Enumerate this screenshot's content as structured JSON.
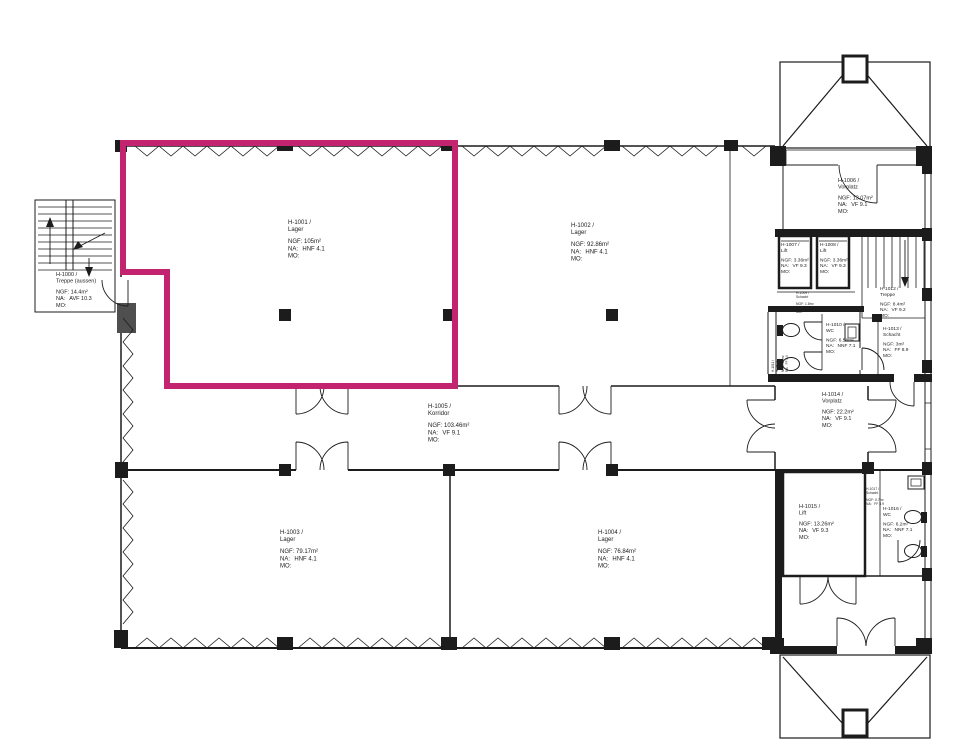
{
  "colors": {
    "highlight": "#c2246f",
    "line": "#1c1c1c"
  },
  "selection": {
    "room_id": "H-1001",
    "room_type": "Lager"
  },
  "rooms": {
    "h1000": {
      "id": "H-1000 /",
      "name": "Treppe (aussen)",
      "ngf": "NGF: 14.4m²",
      "na_label": "NA:",
      "na": "AVF 10.3",
      "mo": "MO:"
    },
    "h1001": {
      "id": "H-1001 /",
      "name": "Lager",
      "ngf": "NGF: 105m²",
      "na_label": "NA:",
      "na": "HNF 4.1",
      "mo": "MO:"
    },
    "h1002": {
      "id": "H-1002 /",
      "name": "Lager",
      "ngf": "NGF: 92.86m²",
      "na_label": "NA:",
      "na": "HNF 4.1",
      "mo": "MO:"
    },
    "h1003": {
      "id": "H-1003 /",
      "name": "Lager",
      "ngf": "NGF: 79.17m²",
      "na_label": "NA:",
      "na": "HNF 4.1",
      "mo": "MO:"
    },
    "h1004": {
      "id": "H-1004 /",
      "name": "Lager",
      "ngf": "NGF: 76.84m²",
      "na_label": "NA:",
      "na": "HNF 4.1",
      "mo": "MO:"
    },
    "h1005": {
      "id": "H-1005 /",
      "name": "Korridor",
      "ngf": "NGF: 103.46m²",
      "na_label": "NA:",
      "na": "VF 9.1",
      "mo": "MO:"
    },
    "h1006": {
      "id": "H-1006 /",
      "name": "Vorplatz",
      "ngf": "NGF: 13.07m²",
      "na_label": "NA:",
      "na": "VF 9.1",
      "mo": "MO:"
    },
    "h1007": {
      "id": "H-1007 /",
      "name": "Lift",
      "ngf": "NGF: 3.36m²",
      "na_label": "NA:",
      "na": "VF 9.3",
      "mo": "MO:"
    },
    "h1008": {
      "id": "H-1008 /",
      "name": "Lift",
      "ngf": "NGF: 3.36m²",
      "na_label": "NA:",
      "na": "VF 9.3",
      "mo": "MO:"
    },
    "h1009": {
      "id": "H-1009 /",
      "name": "Schacht",
      "ngf": "NGF: 1.8m²",
      "na_label": "NA:",
      "na": "FF 8.9",
      "mo": "MO:"
    },
    "h1010": {
      "id": "H-1010 /",
      "name": "WC",
      "ngf": "NGF: 6.58m²",
      "na_label": "NA:",
      "na": "NNF 7.1",
      "mo": "MO:"
    },
    "h1011": {
      "id": "H-1011 /",
      "name": "Schacht",
      "ngf": "NGF: 0.4m²",
      "na_label": "NA:",
      "na": "FF 8.9"
    },
    "h1012": {
      "id": "H-1012 /",
      "name": "Treppe",
      "ngf": "NGF: 8.4m²",
      "na_label": "NA:",
      "na": "VF 9.2",
      "mo": "MO:"
    },
    "h1013": {
      "id": "H-1013 /",
      "name": "Schacht",
      "ngf": "NGF: 3m²",
      "na_label": "NA:",
      "na": "FF 8.9",
      "mo": "MO:"
    },
    "h1014": {
      "id": "H-1014 /",
      "name": "Vorplatz",
      "ngf": "NGF: 22.2m²",
      "na_label": "NA:",
      "na": "VF 9.1",
      "mo": "MO:"
    },
    "h1015": {
      "id": "H-1015 /",
      "name": "Lift",
      "ngf": "NGF: 13.26m²",
      "na_label": "NA:",
      "na": "VF 9.3",
      "mo": "MO:"
    },
    "h1016": {
      "id": "H-1016 /",
      "name": "WC",
      "ngf": "NGF: 6.2m²",
      "na_label": "NA:",
      "na": "NNF 7.1",
      "mo": "MO:"
    },
    "h1017": {
      "id": "H-1017 /",
      "name": "Schacht",
      "ngf": "NGF: 0.7m²",
      "na_label": "NA:",
      "na": "FF 8.9"
    }
  }
}
